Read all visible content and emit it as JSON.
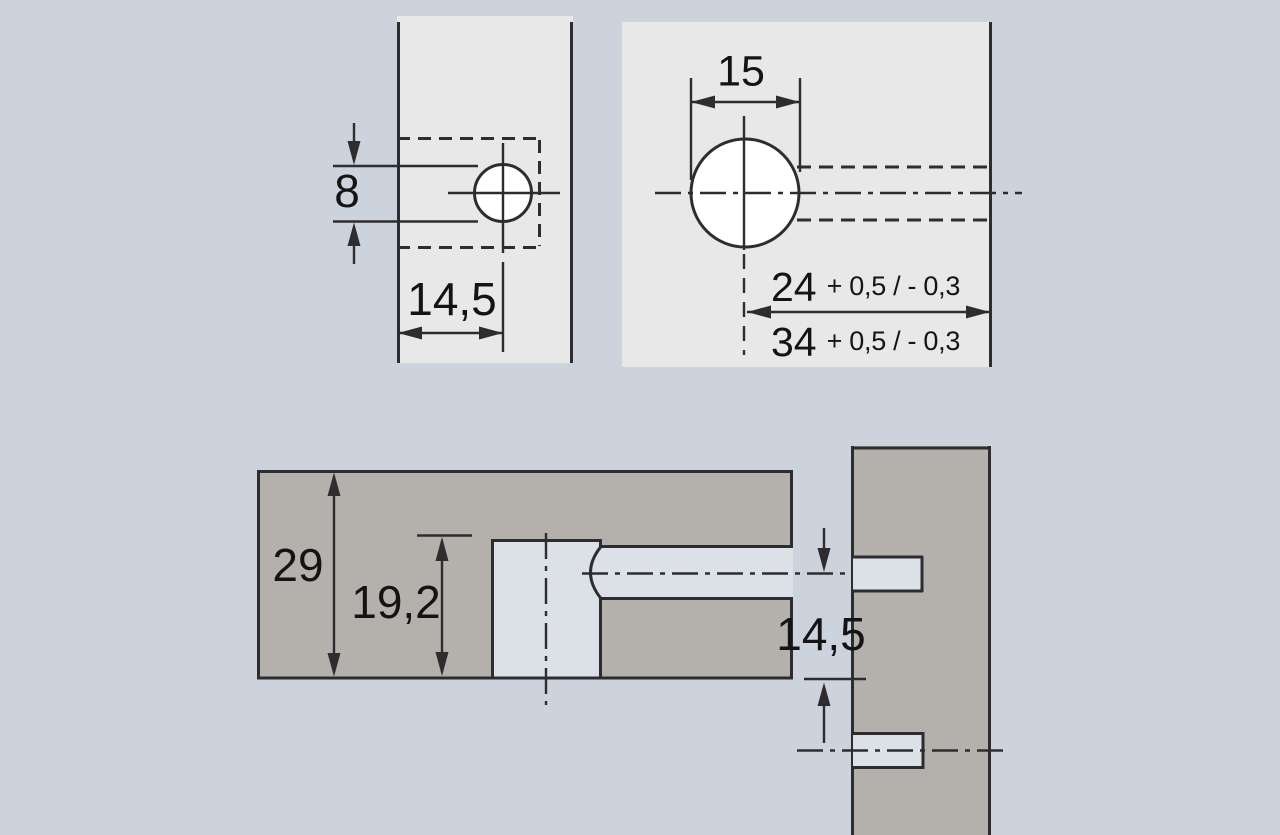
{
  "drawing": {
    "colors": {
      "background": "#ccd3dc",
      "panel_light": "#e8e8e9",
      "panel_dark": "#b4b1ac",
      "cutout": "#dce1e8",
      "line": "#2d2d2f",
      "text": "#141414"
    },
    "side_view": {
      "hole_offset": "8",
      "hole_depth": "14,5"
    },
    "front_view": {
      "hole_width": "15",
      "distance_24": "24",
      "distance_24_tol": "+ 0,5 / - 0,3",
      "distance_34": "34",
      "distance_34_tol": "+ 0,5 / - 0,3"
    },
    "section_view": {
      "panel_thickness": "29",
      "drill_depth": "19,2",
      "axis_to_edge": "14,5"
    }
  }
}
